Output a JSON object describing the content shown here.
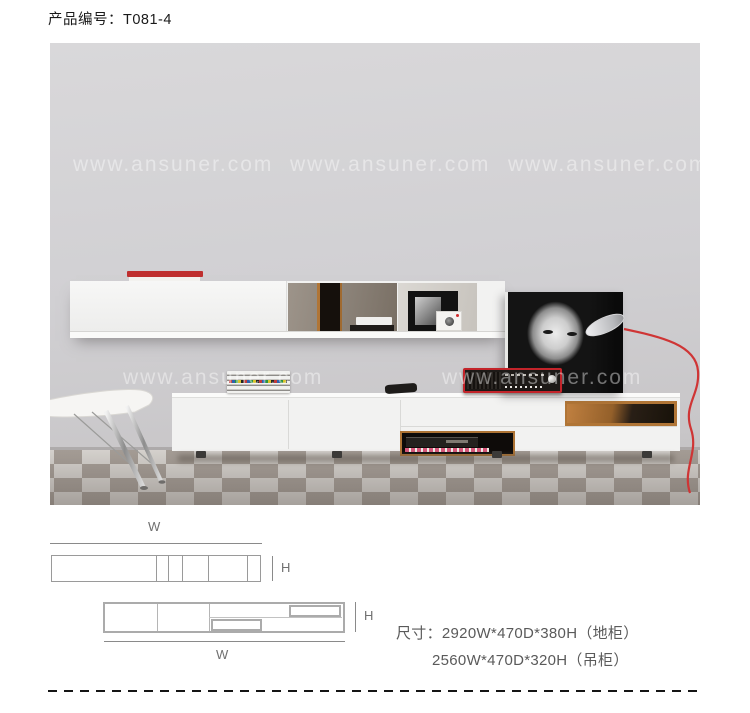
{
  "header": {
    "product_code": "产品编号：T081-4"
  },
  "photo": {
    "watermark": "www.ansuner.com"
  },
  "diagrams": {
    "wall_cabinet": {
      "w": "W",
      "h": "H"
    },
    "tv_stand": {
      "w": "W",
      "h": "H"
    }
  },
  "dimensions": {
    "line1": "尺寸：2920W*470D*380H（地柜）",
    "line2": "2560W*470D*320H（吊柜）"
  },
  "colors": {
    "accent_red": "#c3242a",
    "wood": "#b07536",
    "wall_gray": "#d1d0d3",
    "floor_dark": "#a8a099",
    "floor_light": "#dedbd7"
  }
}
